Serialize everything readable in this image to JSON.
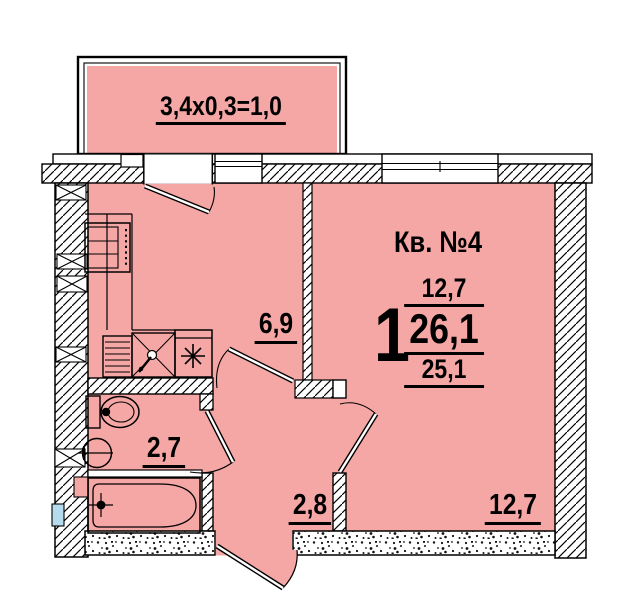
{
  "balcony": {
    "area_formula": "3,4x0,3=1,0"
  },
  "apartment": {
    "number_label": "Кв. №4",
    "rooms_count": "1",
    "living_area": "12,7",
    "total_area": "26,1",
    "area_no_balcony": "25,1"
  },
  "rooms": {
    "kitchen_area": "6,9",
    "bathroom_area": "2,7",
    "hallway_area": "2,8",
    "living_room_area": "12,7"
  },
  "colors": {
    "room_fill": "#f5a7a5",
    "glass": "#b5dcee",
    "line": "#000000"
  },
  "fixtures": [
    "stove-icon",
    "kitchen-sink-icon",
    "counter",
    "toilet-icon",
    "washbasin-icon",
    "bathtub-icon"
  ]
}
